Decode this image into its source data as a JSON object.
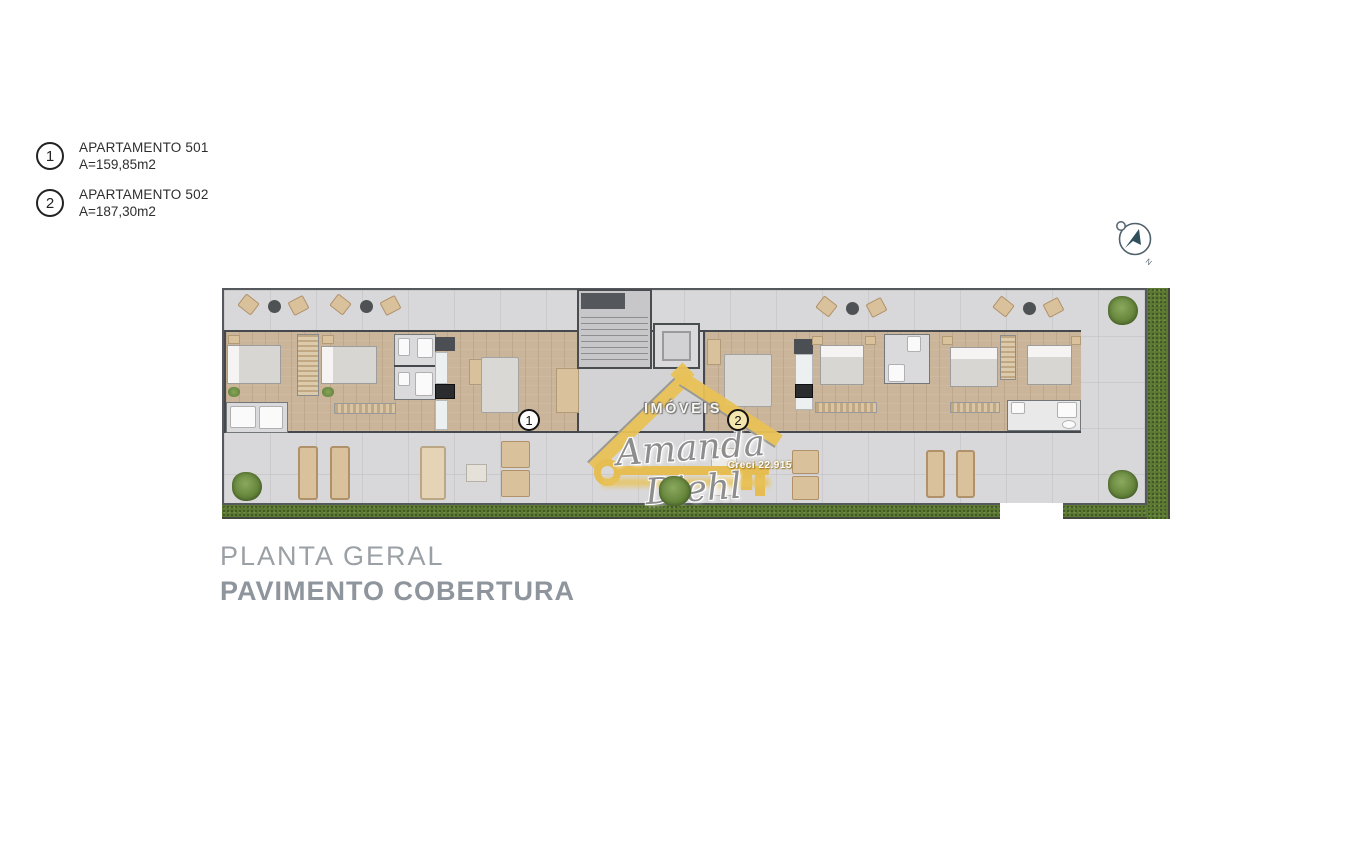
{
  "legend": {
    "items": [
      {
        "number": "1",
        "title": "APARTAMENTO 501",
        "area": "A=159,85m2"
      },
      {
        "number": "2",
        "title": "APARTAMENTO 502",
        "area": "A=187,30m2"
      }
    ]
  },
  "compass": {
    "label": "N"
  },
  "plan": {
    "unit_badges": [
      {
        "number": "1"
      },
      {
        "number": "2"
      }
    ]
  },
  "watermark": {
    "top": "IMÓVEIS",
    "name": "Amanda Diehl",
    "creci": "Creci 22.915"
  },
  "footer": {
    "title": "PLANTA GERAL",
    "subtitle": "PAVIMENTO COBERTURA"
  },
  "colors": {
    "logo_gold": "#e9c155",
    "wood_floor": "#cab59a",
    "terrace_gray": "#d8d8da",
    "grass_green": "#5b7931",
    "wall_dark": "#45484c",
    "title_gray": "#9ba0a5"
  }
}
